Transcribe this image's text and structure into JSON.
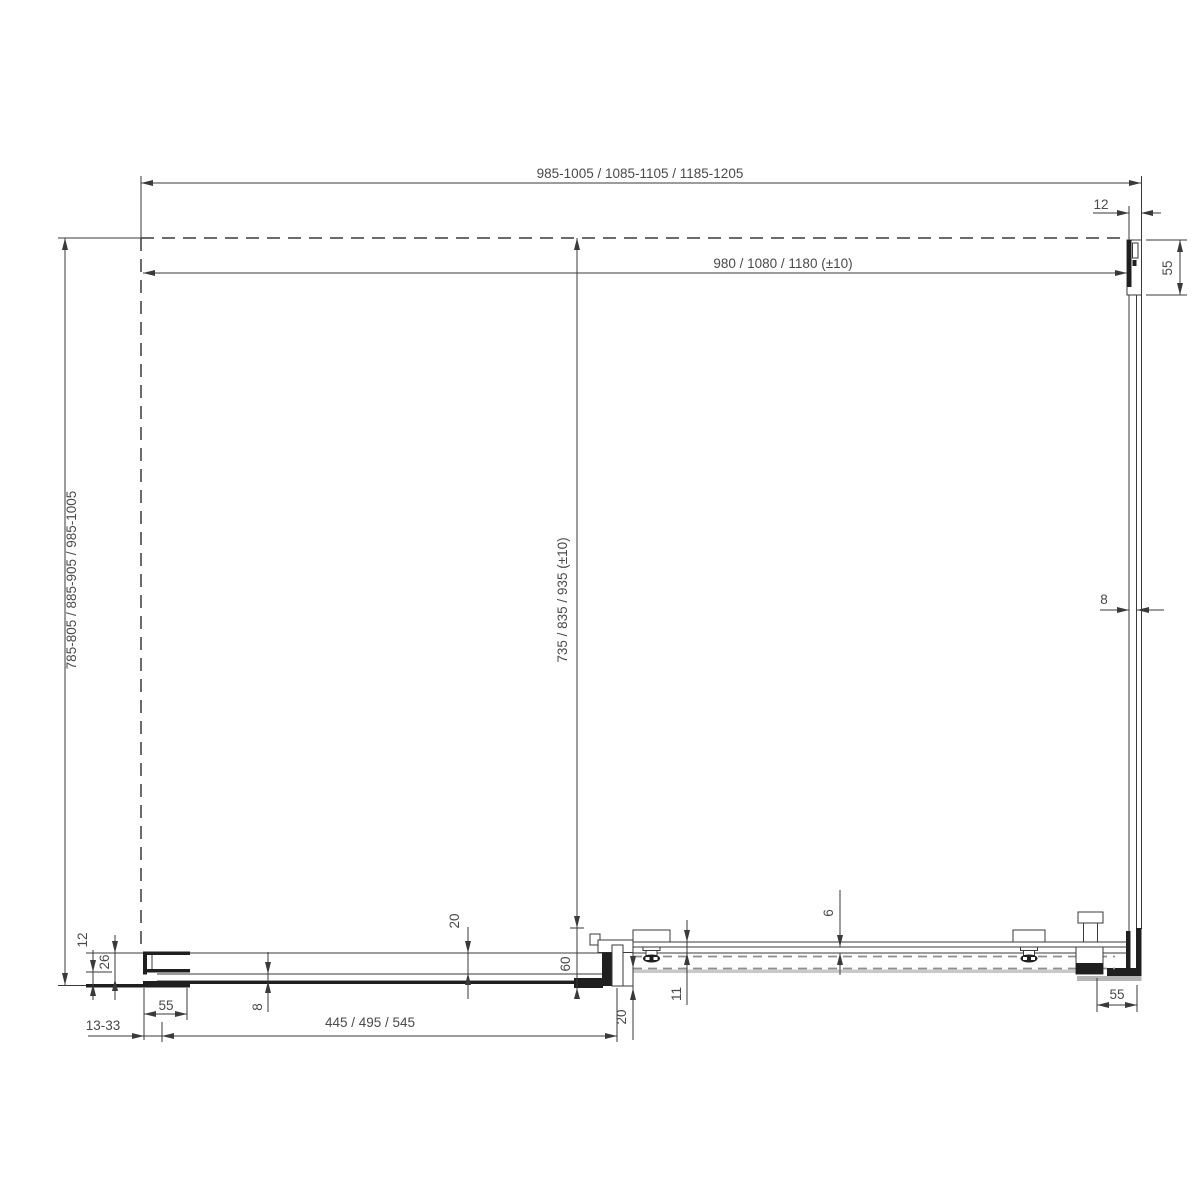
{
  "drawing": {
    "title": "shower-enclosure-plan-view-technical-drawing",
    "dimensions": {
      "outer_width": "985-1005 / 1085-1105 / 1185-1205",
      "inner_width": "980 / 1080 / 1180 (±10)",
      "wall_profile_width_top": "12",
      "wall_profile_depth_top": "55",
      "outer_height": "785-805 / 885-905 / 985-1005",
      "inner_height": "735 / 835 / 935 (±10)",
      "side_glass_thickness": "8",
      "fixed_gap_upper": "20",
      "rail_inset": "6",
      "bottom_left_12": "12",
      "bottom_left_26": "26",
      "bottom_glass_thickness": "8",
      "left_clamp_width": "55",
      "unit_depth": "60",
      "door_overlap": "20",
      "rail_offset": "11",
      "adjustment_range": "13-33",
      "fixed_panel_width": "445 / 495 / 545",
      "right_clamp_width": "55"
    }
  }
}
